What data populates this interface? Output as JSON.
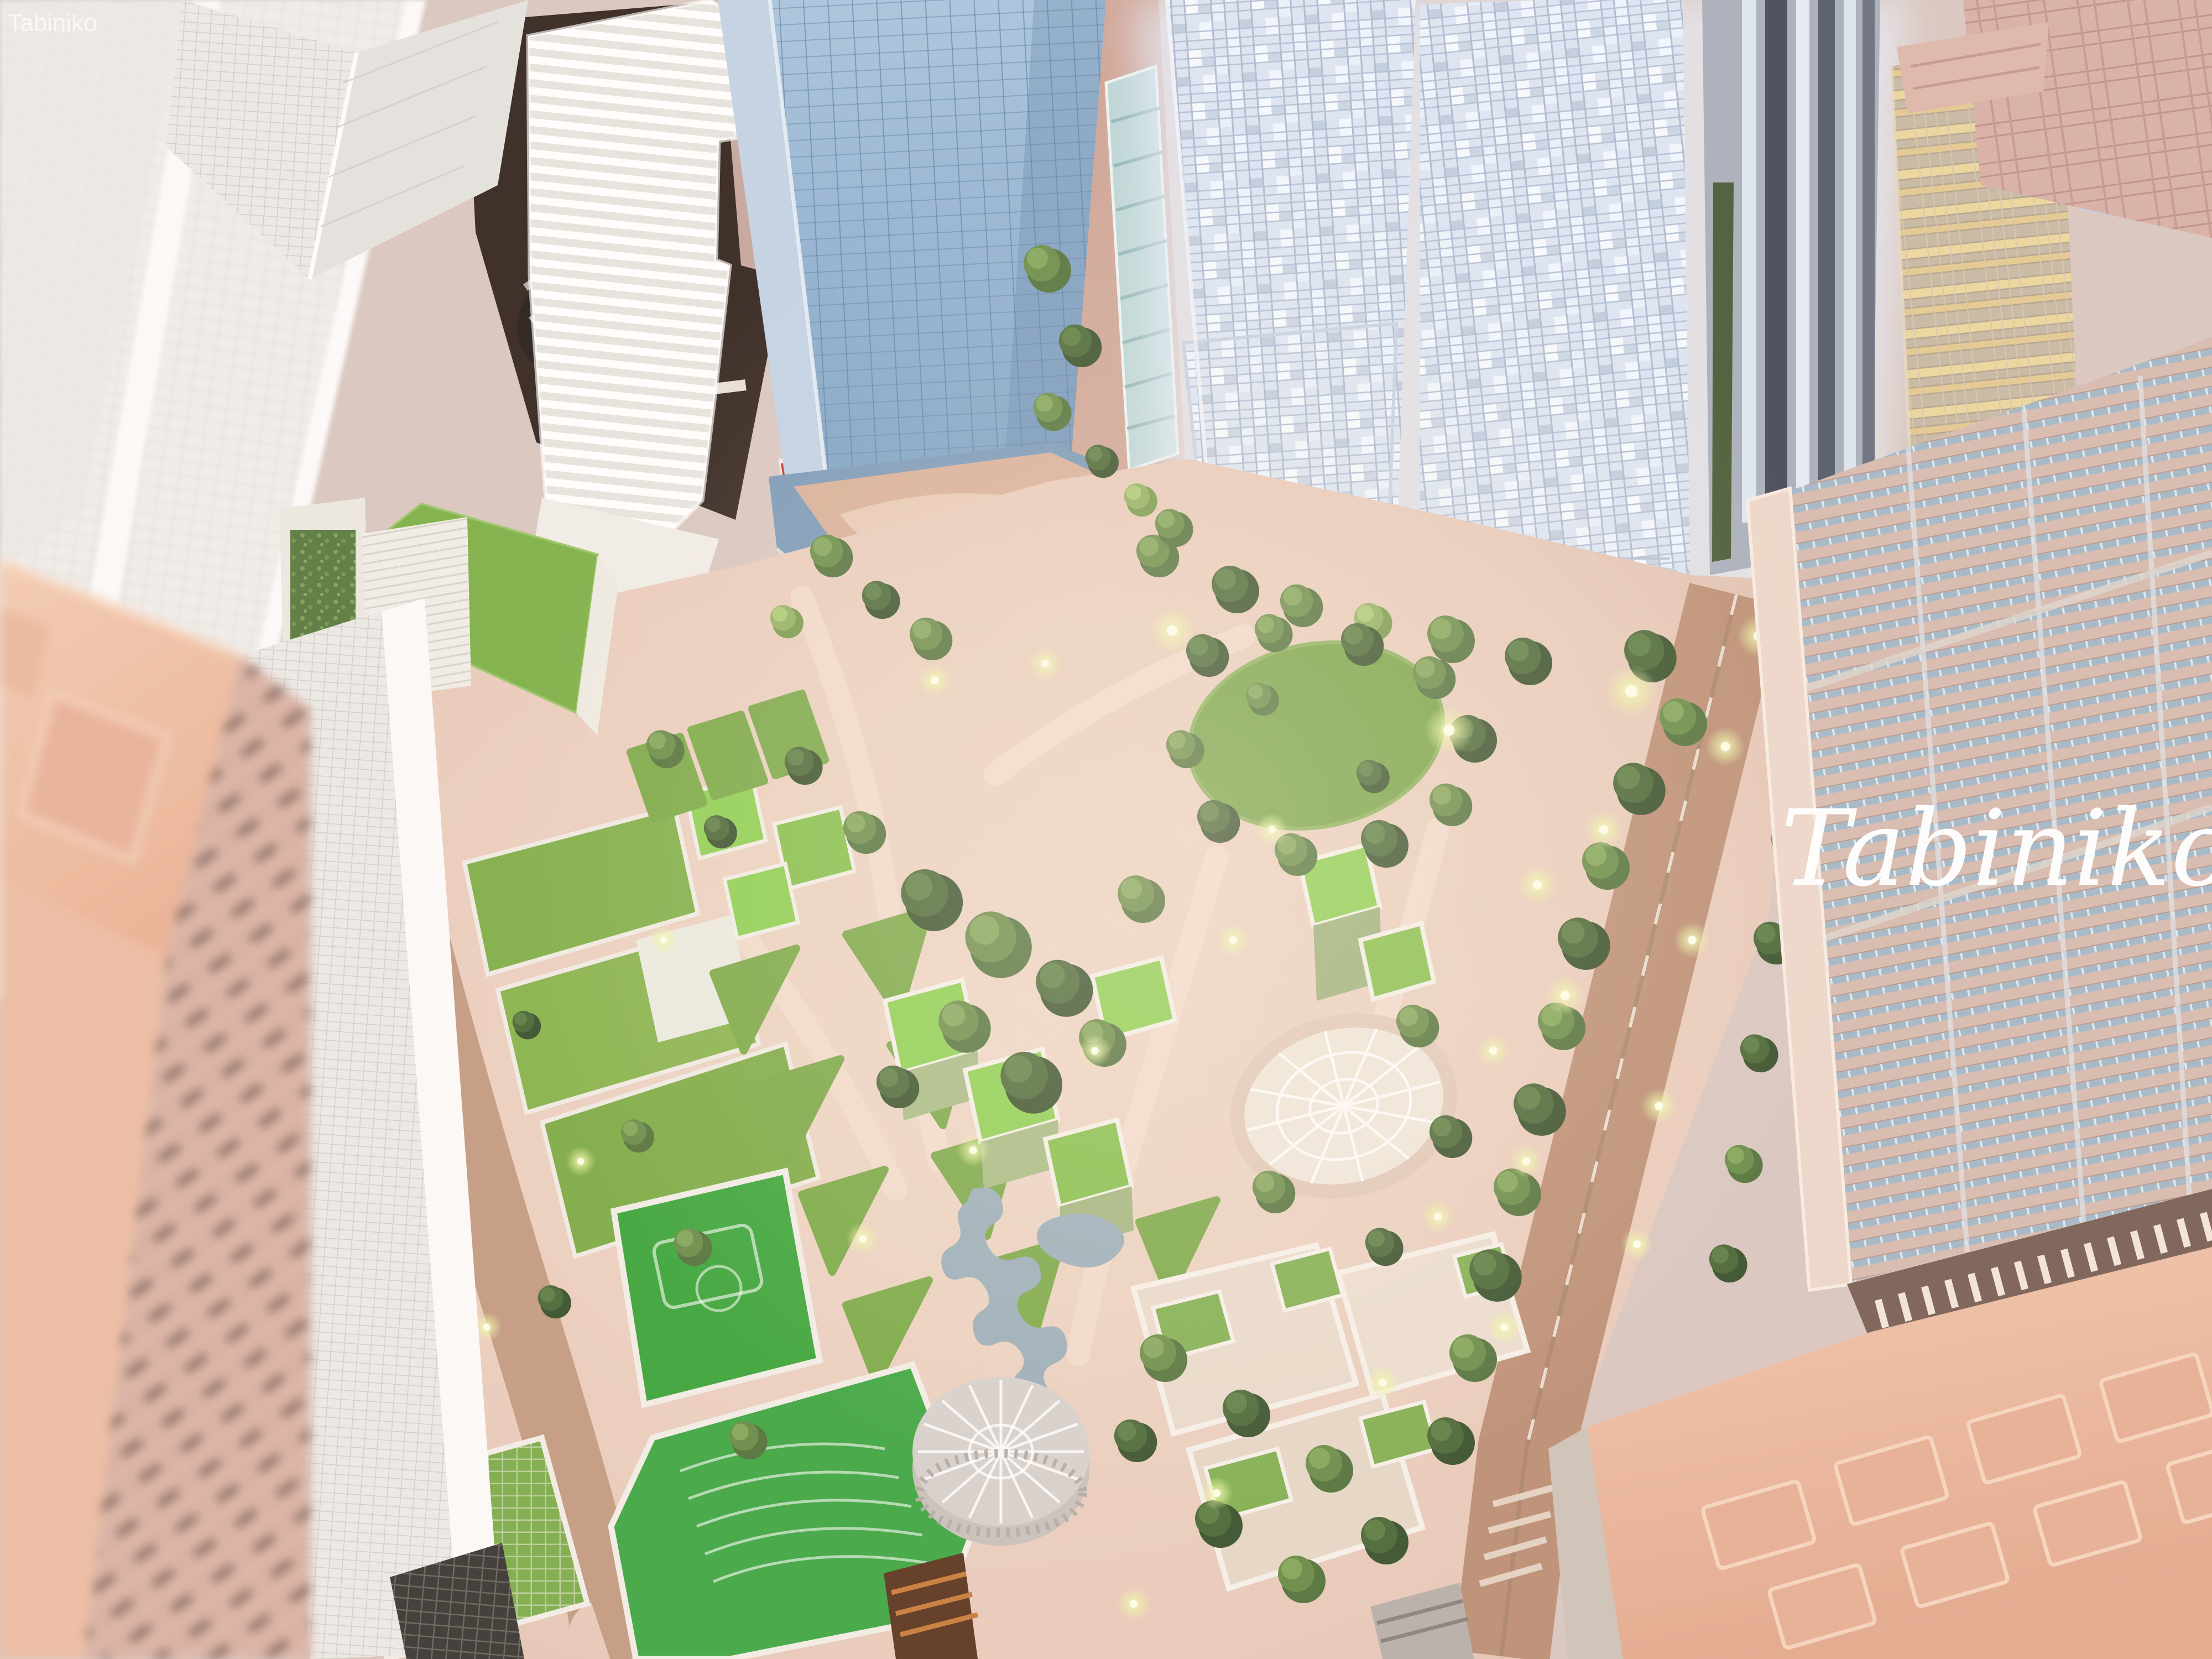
{
  "image": {
    "subject": "Aerial close-up photograph of an illuminated architectural scale model: glass skyscraper towers surrounding a landscaped park district with green-roofed buildings, lawns, sports courts and plazas",
    "medium": "photograph of a city master-plan diorama, shallow depth of field"
  },
  "watermark": {
    "corner_text": "Tabiniko",
    "script_text": "Tabiniko",
    "color": "#ffffff"
  },
  "palette": {
    "salmon_building": "#eab59d",
    "white_tower": "#efefec",
    "blue_tower": "#87abcd",
    "lit_tower": "#e3ecf8",
    "gold_tower": "#e9d49c",
    "park_paving": "#e9cfc0",
    "lawn": "#7cab4a",
    "court_green": "#3fae4b",
    "tree_dark": "#46603a",
    "tree_light": "#93b364",
    "street": "#bf9379",
    "louver_roof": "#d9bcb2",
    "lamp_glow": "#f2fcc0"
  }
}
